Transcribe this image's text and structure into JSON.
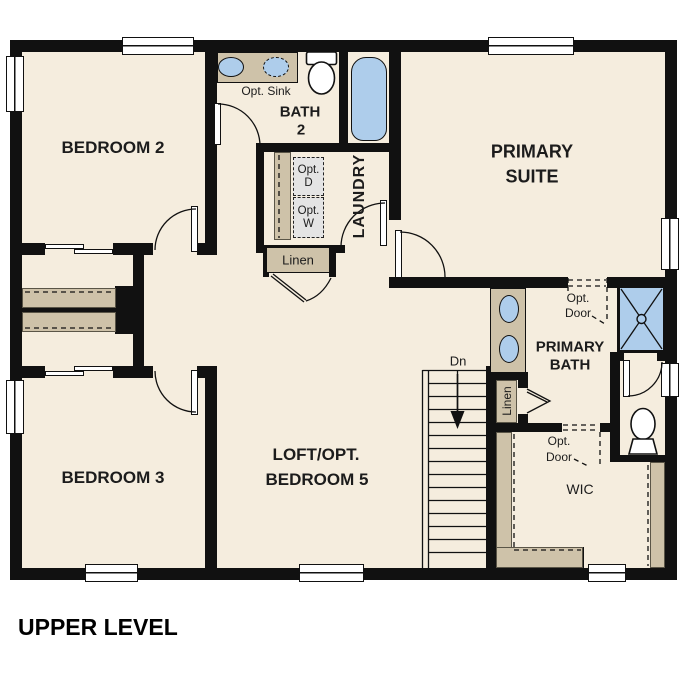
{
  "title": "UPPER LEVEL",
  "colors": {
    "floor": "#f5edde",
    "wall": "#111111",
    "counter": "#cec2a9",
    "fixture_blue": "#aecdeb",
    "appliance_gray": "#e4e4e4",
    "text": "#1c1c1c"
  },
  "labels": {
    "bedroom2": "BEDROOM 2",
    "bedroom3": "BEDROOM 3",
    "primary_suite_1": "PRIMARY",
    "primary_suite_2": "SUITE",
    "loft_1": "LOFT/OPT.",
    "loft_2": "BEDROOM 5",
    "bath2_1": "BATH",
    "bath2_2": "2",
    "opt_sink": "Opt. Sink",
    "laundry": "LAUNDRY",
    "opt_d_1": "Opt.",
    "opt_d_2": "D",
    "opt_w_1": "Opt.",
    "opt_w_2": "W",
    "linen_hall": "Linen",
    "linen_bath": "Linen",
    "stairs_dn": "Dn",
    "opt_door_1": "Opt.",
    "opt_door_2": "Door",
    "primary_bath_1": "PRIMARY",
    "primary_bath_2": "BATH",
    "wic": "WIC"
  }
}
